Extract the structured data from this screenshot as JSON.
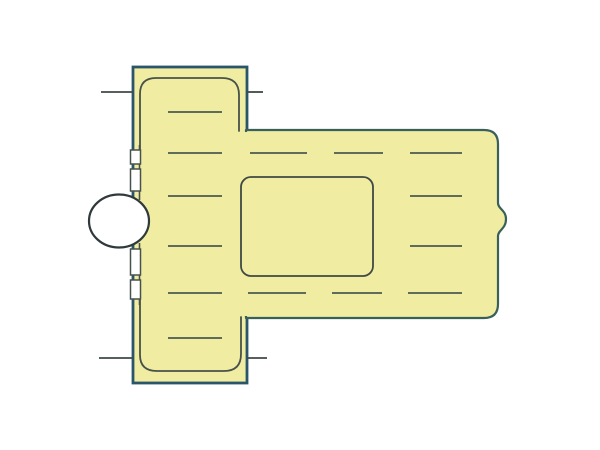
{
  "canvas": {
    "width": 600,
    "height": 450
  },
  "diagram": {
    "kind": "technical-part-illustration",
    "colors": {
      "background": "#ffffff",
      "part_fill": "#f0eda3",
      "flange_outline": "#2b5568",
      "body_outline": "#3a6159",
      "inner_line": "#47524b",
      "hidden_line": "#4b5a50",
      "tick_line": "#3f4a44",
      "window_outline": "#3f4a43",
      "port_fill": "#ffffff",
      "port_outline": "#303a3c"
    },
    "flange": {
      "x": 133,
      "y": 67,
      "width": 114,
      "height": 316
    },
    "body": {
      "left": 246,
      "top": 130,
      "right": 498,
      "bottom": 318,
      "bump_x": 506,
      "bump_y": 220
    },
    "window": {
      "x": 241,
      "y": 177,
      "width": 132,
      "height": 99,
      "radius": 10
    },
    "port": {
      "cx": 119,
      "cy": 221,
      "rx": 30,
      "ry": 26.5
    },
    "hidden_rows": [
      {
        "y": 112,
        "segments": [
          [
            168,
            222
          ]
        ]
      },
      {
        "y": 153,
        "segments": [
          [
            168,
            222
          ],
          [
            250,
            307
          ],
          [
            334,
            383
          ],
          [
            410,
            462
          ]
        ]
      },
      {
        "y": 196,
        "segments": [
          [
            168,
            222
          ],
          [
            410,
            462
          ]
        ]
      },
      {
        "y": 246,
        "segments": [
          [
            168,
            222
          ],
          [
            410,
            462
          ]
        ]
      },
      {
        "y": 293,
        "segments": [
          [
            168,
            222
          ],
          [
            248,
            306
          ],
          [
            332,
            382
          ],
          [
            408,
            462
          ]
        ]
      },
      {
        "y": 338,
        "segments": [
          [
            168,
            222
          ]
        ]
      }
    ],
    "ticks": [
      {
        "y": 92,
        "segments": [
          [
            101,
            133
          ],
          [
            247,
            263
          ]
        ]
      },
      {
        "y": 358,
        "segments": [
          [
            99,
            133
          ],
          [
            247,
            267
          ]
        ]
      }
    ],
    "notches": {
      "x": 130.5,
      "width": 10,
      "items": [
        {
          "y": 150,
          "h": 14
        },
        {
          "y": 169,
          "h": 22
        },
        {
          "y": 249,
          "h": 26
        },
        {
          "y": 280,
          "h": 19
        }
      ]
    }
  }
}
